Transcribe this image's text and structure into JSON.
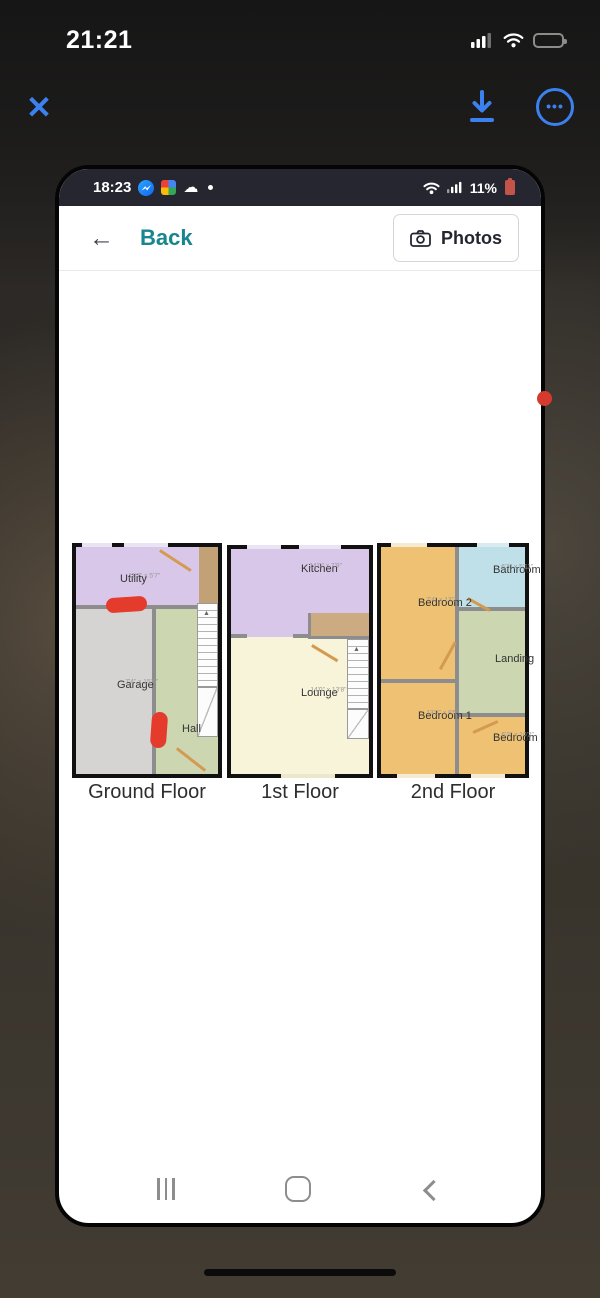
{
  "ios": {
    "time": "21:21"
  },
  "viewer": {
    "close_glyph": "✕",
    "more_glyph": "•••"
  },
  "phone": {
    "status": {
      "time": "18:23",
      "battery": "11%",
      "cloud_glyph": "☁"
    },
    "app_bar": {
      "back": "Back",
      "photos": "Photos"
    }
  },
  "floors": [
    {
      "label": "Ground Floor",
      "rooms": [
        {
          "name": "Utility",
          "dims": "11'7\" x 5'7\""
        },
        {
          "name": "Garage",
          "dims": "7'4\" x 15'6\""
        },
        {
          "name": "Hall",
          "dims": ""
        }
      ]
    },
    {
      "label": "1st Floor",
      "rooms": [
        {
          "name": "Kitchen",
          "dims": "14'0\" x 7'9\""
        },
        {
          "name": "Lounge",
          "dims": "14'0\" x 13'8\""
        }
      ]
    },
    {
      "label": "2nd Floor",
      "rooms": [
        {
          "name": "Bedroom 2",
          "dims": "7'4\" x 13'2\""
        },
        {
          "name": "Bathroom",
          "dims": "6'3\" x 5'11\""
        },
        {
          "name": "Landing",
          "dims": ""
        },
        {
          "name": "Bedroom 1",
          "dims": "13'3\" x 8'5\""
        },
        {
          "name": "Bedroom 3",
          "dims": "6'3\" x 10'2\""
        }
      ]
    }
  ],
  "colors": {
    "accent_blue": "#3b82f0",
    "teal": "#17868f",
    "room_lavender": "#d9c7e9",
    "room_gray": "#d5d4d2",
    "room_green": "#ccd6b1",
    "room_cream": "#f8f4d9",
    "room_orange": "#eec173",
    "room_blue": "#bfe0e8",
    "annotation_red": "#e43b2c"
  }
}
